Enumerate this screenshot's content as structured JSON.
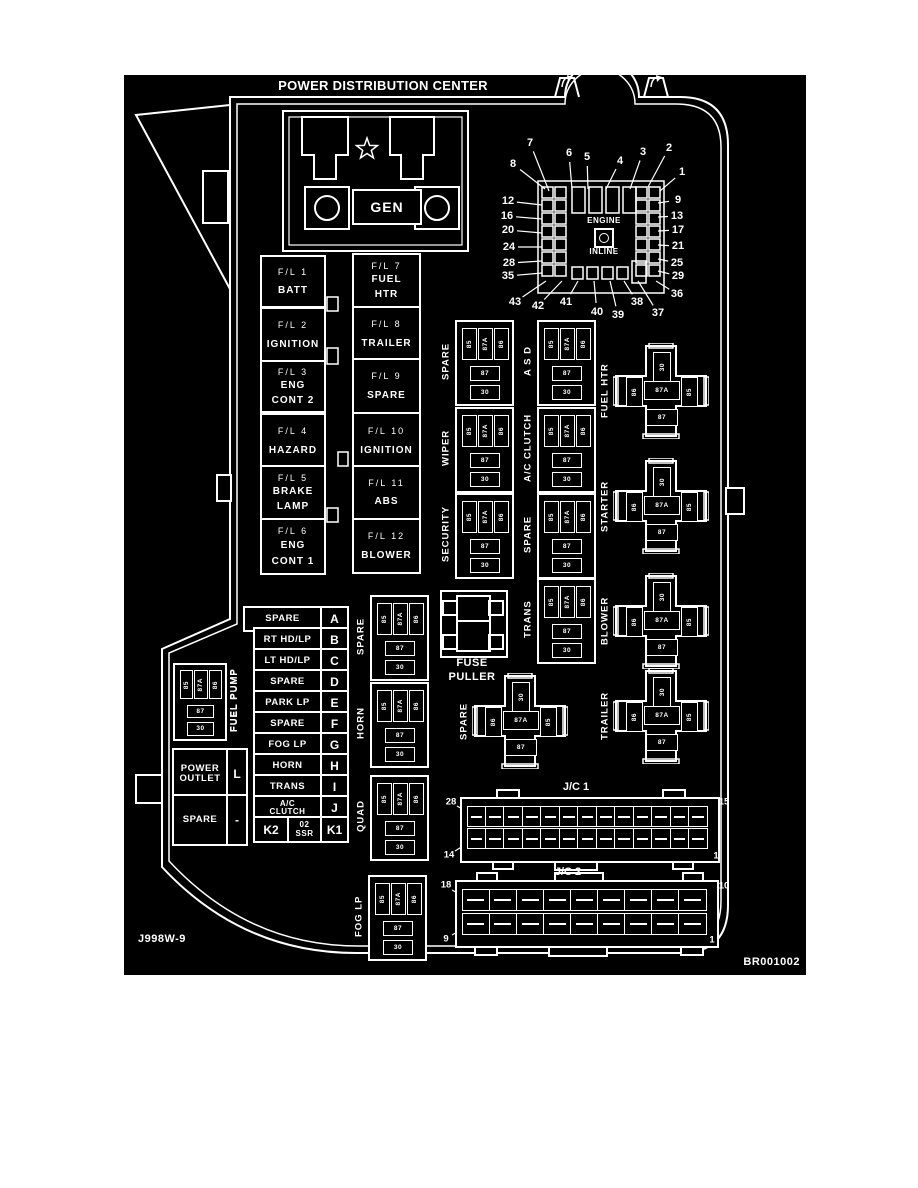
{
  "title": "POWER DISTRIBUTION CENTER",
  "doc_refs": {
    "left": "J998W-9",
    "right": "BR001002"
  },
  "gen": {
    "label": "GEN"
  },
  "fuse_grid": {
    "engine": "ENGINE",
    "inline": "INLINE",
    "top": [
      "7",
      "6",
      "5",
      "4",
      "3",
      "2"
    ],
    "corner_tr": "1",
    "left": [
      "8",
      "12",
      "16",
      "20",
      "24",
      "28",
      "35"
    ],
    "right": [
      "9",
      "13",
      "17",
      "21",
      "25",
      "29"
    ],
    "corner_br": "36",
    "bottom": [
      "43",
      "42",
      "41",
      "40",
      "39",
      "38",
      "37"
    ]
  },
  "fusible_links": {
    "left": [
      {
        "id": "F/L 1",
        "lines": [
          "BATT"
        ]
      },
      {
        "id": "F/L 2",
        "lines": [
          "IGNITION"
        ]
      },
      {
        "id": "F/L 3",
        "lines": [
          "ENG",
          "CONT 2"
        ]
      },
      {
        "id": "F/L 4",
        "lines": [
          "HAZARD"
        ]
      },
      {
        "id": "F/L 5",
        "lines": [
          "BRAKE",
          "LAMP"
        ]
      },
      {
        "id": "F/L 6",
        "lines": [
          "ENG",
          "CONT 1"
        ]
      }
    ],
    "right": [
      {
        "id": "F/L 7",
        "lines": [
          "FUEL",
          "HTR"
        ]
      },
      {
        "id": "F/L 8",
        "lines": [
          "TRAILER"
        ]
      },
      {
        "id": "F/L 9",
        "lines": [
          "SPARE"
        ]
      },
      {
        "id": "F/L 10",
        "lines": [
          "IGNITION"
        ]
      },
      {
        "id": "F/L 11",
        "lines": [
          "ABS"
        ]
      },
      {
        "id": "F/L 12",
        "lines": [
          "BLOWER"
        ]
      }
    ]
  },
  "relay_pins": {
    "coil_row": [
      "85",
      "87A",
      "86"
    ],
    "mid": "87",
    "bottom": "30"
  },
  "cross_pins": {
    "top": "30",
    "left": "86",
    "center": "87A",
    "right": "85",
    "bottom": "87"
  },
  "box_relays": [
    "SPARE",
    "A S D",
    "WIPER",
    "A/C CLUTCH",
    "SECURITY",
    "SPARE",
    "TRANS",
    "SPARE",
    "HORN",
    "QUAD",
    "FOG LP",
    "FUEL PUMP"
  ],
  "cross_relays": [
    "FUEL HTR",
    "STARTER",
    "BLOWER",
    "TRAILER",
    "SPARE"
  ],
  "fuse_list": {
    "rows": [
      {
        "lines": [
          "SPARE"
        ],
        "letter": "A"
      },
      {
        "lines": [
          "RT HD/LP"
        ],
        "letter": "B"
      },
      {
        "lines": [
          "LT HD/LP"
        ],
        "letter": "C"
      },
      {
        "lines": [
          "SPARE"
        ],
        "letter": "D"
      },
      {
        "lines": [
          "PARK LP"
        ],
        "letter": "E"
      },
      {
        "lines": [
          "SPARE"
        ],
        "letter": "F"
      },
      {
        "lines": [
          "FOG LP"
        ],
        "letter": "G"
      },
      {
        "lines": [
          "HORN"
        ],
        "letter": "H"
      },
      {
        "lines": [
          "TRANS"
        ],
        "letter": "I"
      },
      {
        "lines": [
          "A/C",
          "CLUTCH"
        ],
        "letter": "J"
      }
    ],
    "bottom_row": {
      "left": "K2",
      "center_lines": [
        "02",
        "SSR"
      ],
      "right": "K1"
    }
  },
  "power_outlet": {
    "rows": [
      {
        "lines": [
          "POWER",
          "OUTLET"
        ],
        "letter": "L"
      },
      {
        "lines": [
          "SPARE"
        ],
        "letter": "-"
      }
    ]
  },
  "fuse_puller": {
    "lines": [
      "FUSE",
      "PULLER"
    ]
  },
  "junction_connectors": [
    {
      "label": "J/C 1",
      "corner_tl": "28",
      "corner_tr": "15",
      "corner_bl": "14",
      "corner_br": "1"
    },
    {
      "label": "J/C 2",
      "corner_tl": "18",
      "corner_tr": "10",
      "corner_bl": "9",
      "corner_br": "1"
    }
  ]
}
